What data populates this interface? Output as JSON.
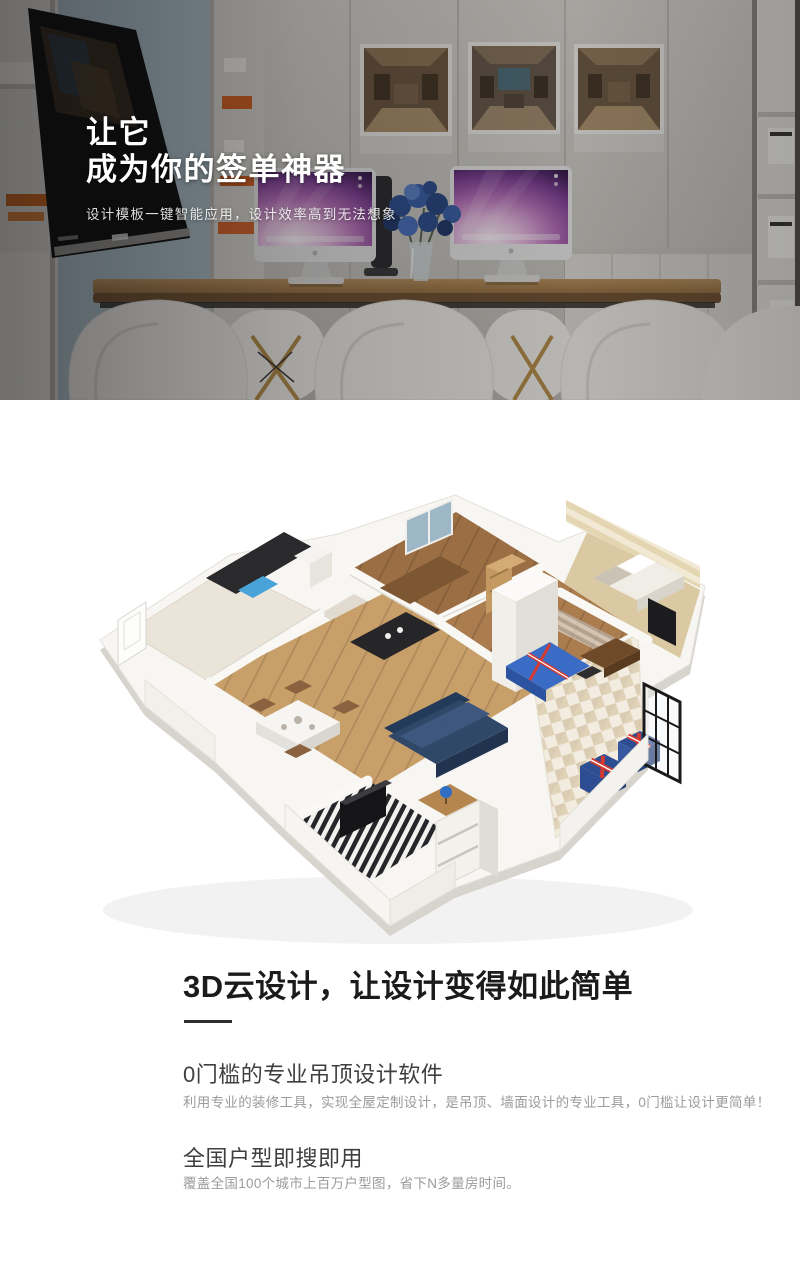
{
  "hero": {
    "title_line1": "让它",
    "title_line2": "成为你的签单神器",
    "subtitle": "设计模板一键智能应用，设计效率高到无法想象"
  },
  "content": {
    "heading": "3D云设计，让设计变得如此简单",
    "features": [
      {
        "title": "0门槛的专业吊顶设计软件",
        "desc": "利用专业的装修工具，实现全屋定制设计，是吊顶、墙面设计的专业工具，0门槛让设计更简单！"
      },
      {
        "title": "全国户型即搜即用",
        "desc": "覆盖全国100个城市上百万户型图，省下N多量房时间。"
      }
    ]
  },
  "colors": {
    "heading_text": "#1b1b1b",
    "subheading_text": "#3f3f3f",
    "body_text": "#9b9b9b",
    "hero_text": "#ffffff"
  }
}
